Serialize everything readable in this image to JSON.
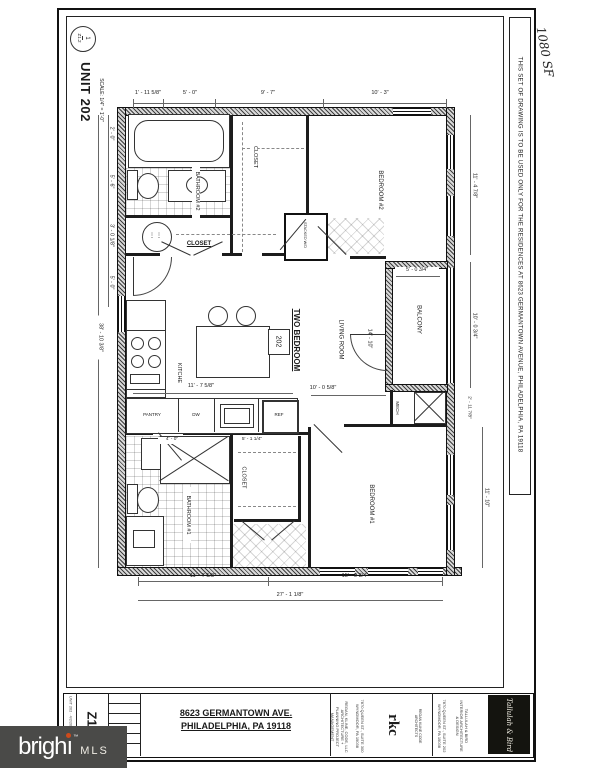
{
  "sheet": {
    "callout_number": "1",
    "callout_sheet": "Z1.2",
    "title": "UNIT 202",
    "scale": "SCALE:  1/4\" = 1'-0\"",
    "area_note": "1080 SF",
    "side_note": "THIS SET OF DRAWING IS TO BE USED ONLY FOR THE RESIDENCES AT 8623 GERMANTOWN AVENUE, PHILADELPHIA, PA 19118"
  },
  "unit": {
    "type": "TWO BEDROOM",
    "number": "202"
  },
  "rooms": {
    "bathroom2": "BATHROOM #2",
    "closet_top": "CLOSET",
    "bedroom2": "BEDROOM #2",
    "entry_closet": "CLOSET",
    "wd": "STACKED W/D",
    "kitchen": "KITCHEN",
    "living": "LIVING ROOM",
    "balcony": "BALCONY",
    "mech": "MECH",
    "bathroom1": "BATHROOM #1",
    "closet1": "CLOSET",
    "bedroom1": "BEDROOM #1"
  },
  "appliances": {
    "pantry": "PANTRY",
    "dw": "DW",
    "ref": "REF"
  },
  "dimensions": {
    "top": [
      "1' - 11 5/8\"",
      "5' - 0\"",
      "9' - 7\"",
      "10' - 3\""
    ],
    "left": [
      "2' - 0\"",
      "5' - 6\"",
      "3' - 0 1/8\"",
      "5' - 0\""
    ],
    "left_overall": "38' - 10 3/8\"",
    "right": [
      "11' - 4 7/8\"",
      "10' - 0 3/4\"",
      "2' - 11 7/8\"",
      "11' - 10\""
    ],
    "bottom": [
      "11' - 7 5/8\"",
      "15' - 0 3/4\""
    ],
    "bottom_overall": "27' - 1 1/8\"",
    "balcony_width": "5' - 0 3/4\"",
    "living_depth": "14' - 10\"",
    "living_width": "10' - 0 5/8\"",
    "kitchen_width": "11' - 7 5/8\"",
    "shower": "4' - 0\"",
    "closet1": "5' - 1 1/4\""
  },
  "title_block": {
    "sheet_number": "Z1.2",
    "address_line1": "8623 GERMANTOWN AVE.",
    "address_line2": "PHILADELPHIA, PA 19118",
    "meta": "UNIT 202  ·  4/2/2019  ·  AS NOTED",
    "architect": {
      "logo": "rkc",
      "name": "REGAN KLINE CODE ARCHITECTS",
      "services": "REGAN, KLINE, CODE, LLC ARCHITECTURE + PLANNING PROJECT MANAGEMENT",
      "address": "7870 QUEEN ST., SUITE 300 WYNDMOOR, PA 19038"
    },
    "designer": {
      "logo": "Tallulah & Bird",
      "name": "TALLULAH & BIRD INTERIOR ARCHITECTURE & DESIGN",
      "address": "7870 QUEEN ST., SUITE 202 WYNDMOOR, PA 19038"
    }
  },
  "watermark": {
    "part1": "brigh",
    "part2": "ı",
    "tm": "™",
    "suffix": "MLS"
  }
}
